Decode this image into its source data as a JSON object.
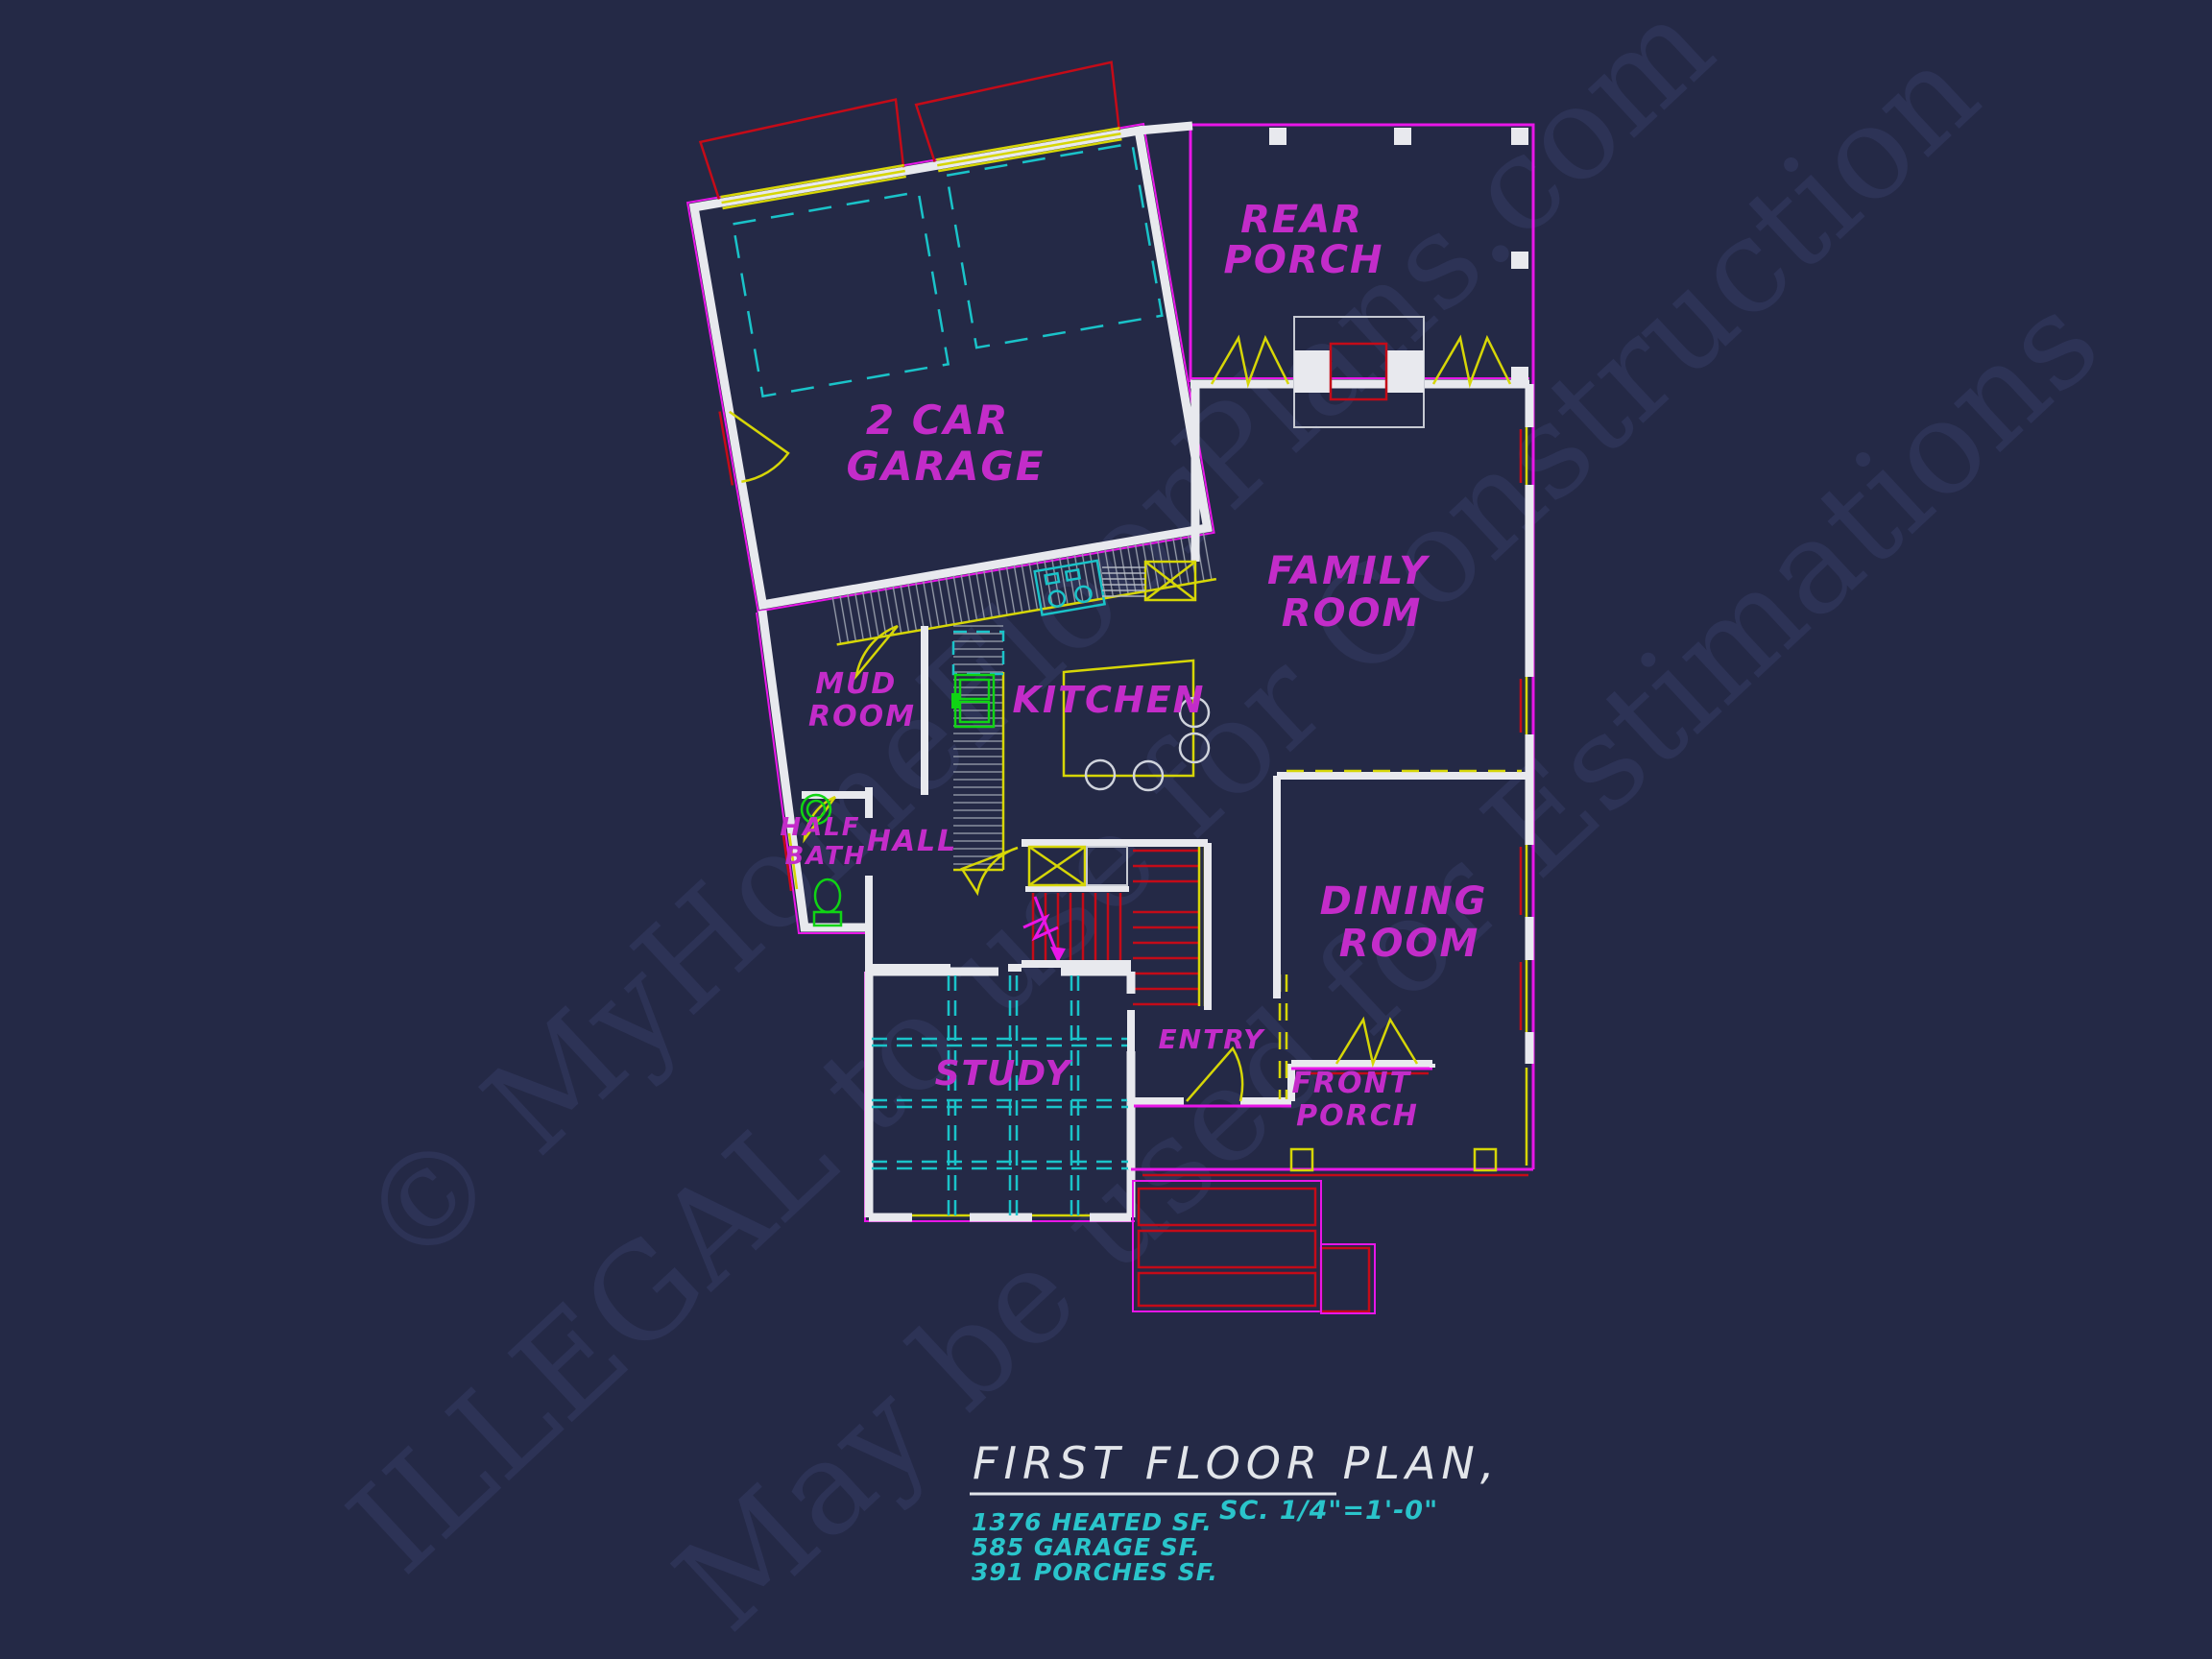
{
  "title_block": {
    "title": "FIRST FLOOR PLAN,",
    "scale": "SC. 1/4\"=1'-0\"",
    "stats": [
      "1376 HEATED SF.",
      "585 GARAGE SF.",
      "391 PORCHES SF."
    ]
  },
  "rooms": {
    "rear_porch": {
      "line1": "REAR",
      "line2": "PORCH"
    },
    "garage": {
      "line1": "2 CAR",
      "line2": "GARAGE"
    },
    "family_room": {
      "line1": "FAMILY",
      "line2": "ROOM"
    },
    "mud_room": {
      "line1": "MUD",
      "line2": "ROOM"
    },
    "kitchen": {
      "line1": "KITCHEN"
    },
    "half_bath": {
      "line1": "HALF",
      "line2": "BATH"
    },
    "hall": {
      "line1": "HALL"
    },
    "dining_room": {
      "line1": "DINING",
      "line2": "ROOM"
    },
    "study": {
      "line1": "STUDY"
    },
    "entry": {
      "line1": "ENTRY"
    },
    "front_porch": {
      "line1": "FRONT",
      "line2": "PORCH"
    }
  },
  "watermark": {
    "line1": "© MyHomeFloorPlans.com",
    "line2": "ILLEGAL to use for Construction",
    "line3": "May be used for Estimations"
  },
  "colors": {
    "background": "#242946",
    "wall_white": "#e8e9ee",
    "magenta_line": "#e816e8",
    "label_magenta": "#c32cc9",
    "yellow": "#d6d607",
    "cyan": "#1ac3c9",
    "red": "#c40b18",
    "green": "#10d414",
    "cyan_text": "#2ac4cb",
    "title_text": "#e2e5ea",
    "watermark": "#3a416d"
  }
}
